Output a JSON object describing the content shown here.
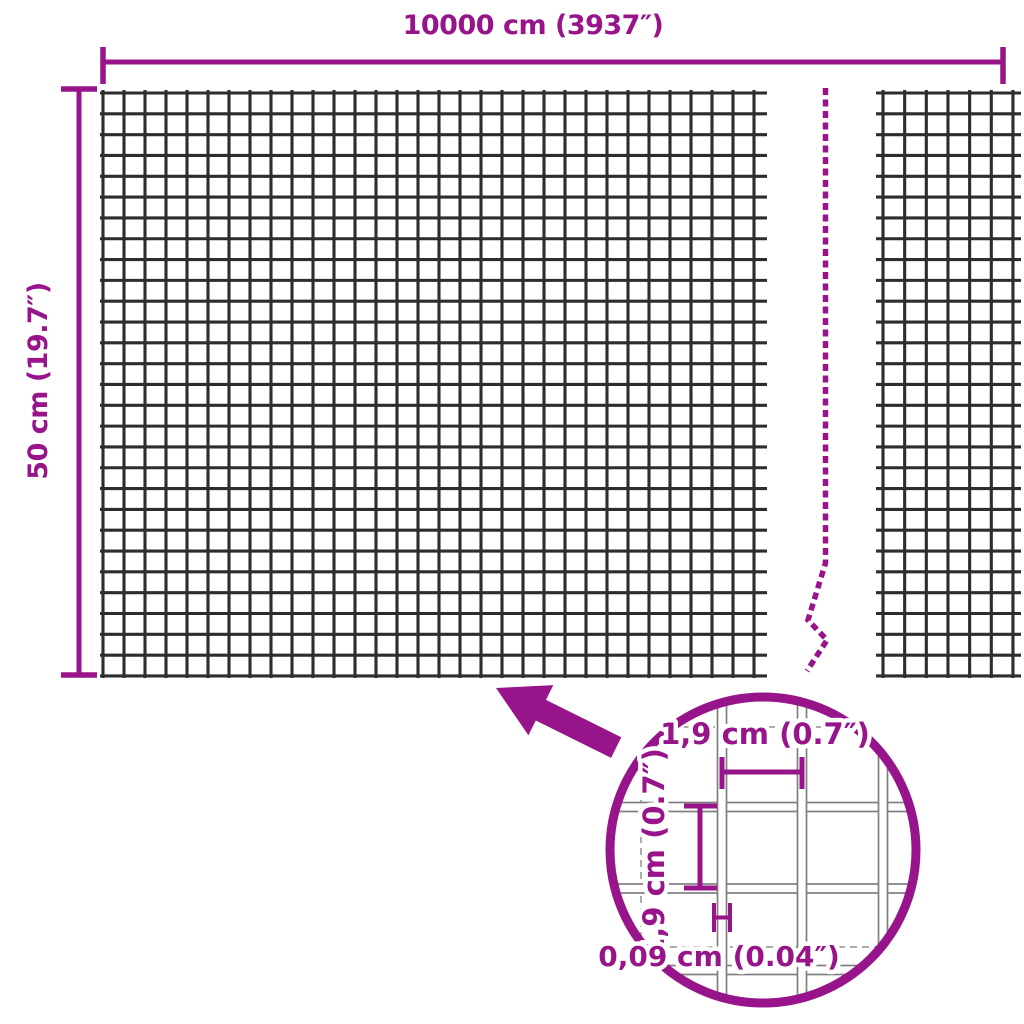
{
  "colors": {
    "accent": "#97148a",
    "wire_dark": "#2d2d2d",
    "wire_gray": "#7f7f7f",
    "dash_gray": "#9e9e9e",
    "background": "#ffffff"
  },
  "dimensions": {
    "total_width_label": "10000 cm (3937″)",
    "total_height_label": "50 cm (19.7″)"
  },
  "detail_callout": {
    "mesh_width_label": "1,9 cm (0.7″)",
    "mesh_height_label": "1,9 cm (0.7″)",
    "wire_thickness_label": "0,09 cm (0.04″)"
  }
}
